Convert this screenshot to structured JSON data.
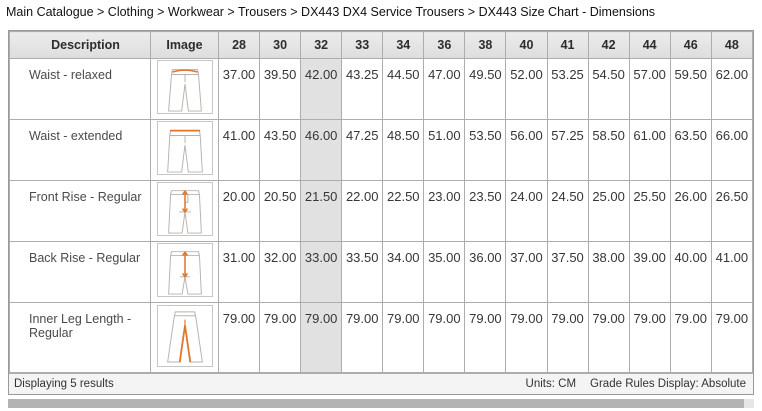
{
  "breadcrumb": {
    "text": "Main Catalogue > Clothing > Workwear > Trousers > DX443 DX4 Service Trousers > DX443 Size Chart - Dimensions"
  },
  "table": {
    "description_header": "Description",
    "image_header": "Image",
    "size_headers": [
      "28",
      "30",
      "32",
      "33",
      "34",
      "36",
      "38",
      "40",
      "41",
      "42",
      "44",
      "46",
      "48"
    ],
    "highlighted_size": "32",
    "highlighted_index": 2,
    "rows": [
      {
        "description": "Waist - relaxed",
        "image_icon": "trousers-waist-relaxed-diagram",
        "values": [
          "37.00",
          "39.50",
          "42.00",
          "43.25",
          "44.50",
          "47.00",
          "49.50",
          "52.00",
          "53.25",
          "54.50",
          "57.00",
          "59.50",
          "62.00"
        ]
      },
      {
        "description": "Waist - extended",
        "image_icon": "trousers-waist-extended-diagram",
        "values": [
          "41.00",
          "43.50",
          "46.00",
          "47.25",
          "48.50",
          "51.00",
          "53.50",
          "56.00",
          "57.25",
          "58.50",
          "61.00",
          "63.50",
          "66.00"
        ]
      },
      {
        "description": "Front Rise - Regular",
        "image_icon": "trousers-front-rise-diagram",
        "values": [
          "20.00",
          "20.50",
          "21.50",
          "22.00",
          "22.50",
          "23.00",
          "23.50",
          "24.00",
          "24.50",
          "25.00",
          "25.50",
          "26.00",
          "26.50"
        ]
      },
      {
        "description": "Back Rise - Regular",
        "image_icon": "trousers-back-rise-diagram",
        "values": [
          "31.00",
          "32.00",
          "33.00",
          "33.50",
          "34.00",
          "35.00",
          "36.00",
          "37.00",
          "37.50",
          "38.00",
          "39.00",
          "40.00",
          "41.00"
        ]
      },
      {
        "description": "Inner Leg Length - Regular",
        "image_icon": "trousers-inner-leg-diagram",
        "values": [
          "79.00",
          "79.00",
          "79.00",
          "79.00",
          "79.00",
          "79.00",
          "79.00",
          "79.00",
          "79.00",
          "79.00",
          "79.00",
          "79.00",
          "79.00"
        ]
      }
    ]
  },
  "footer": {
    "results_text": "Displaying 5 results",
    "units_label": "Units: CM",
    "grade_rules_label": "Grade Rules Display: Absolute"
  },
  "colors": {
    "accent_orange": "#e0762c",
    "header_bg": "#e4e4e4",
    "highlight_header_bg": "#c9c9c9",
    "highlight_cell_bg": "#e1e1e1",
    "border": "#adadad"
  }
}
